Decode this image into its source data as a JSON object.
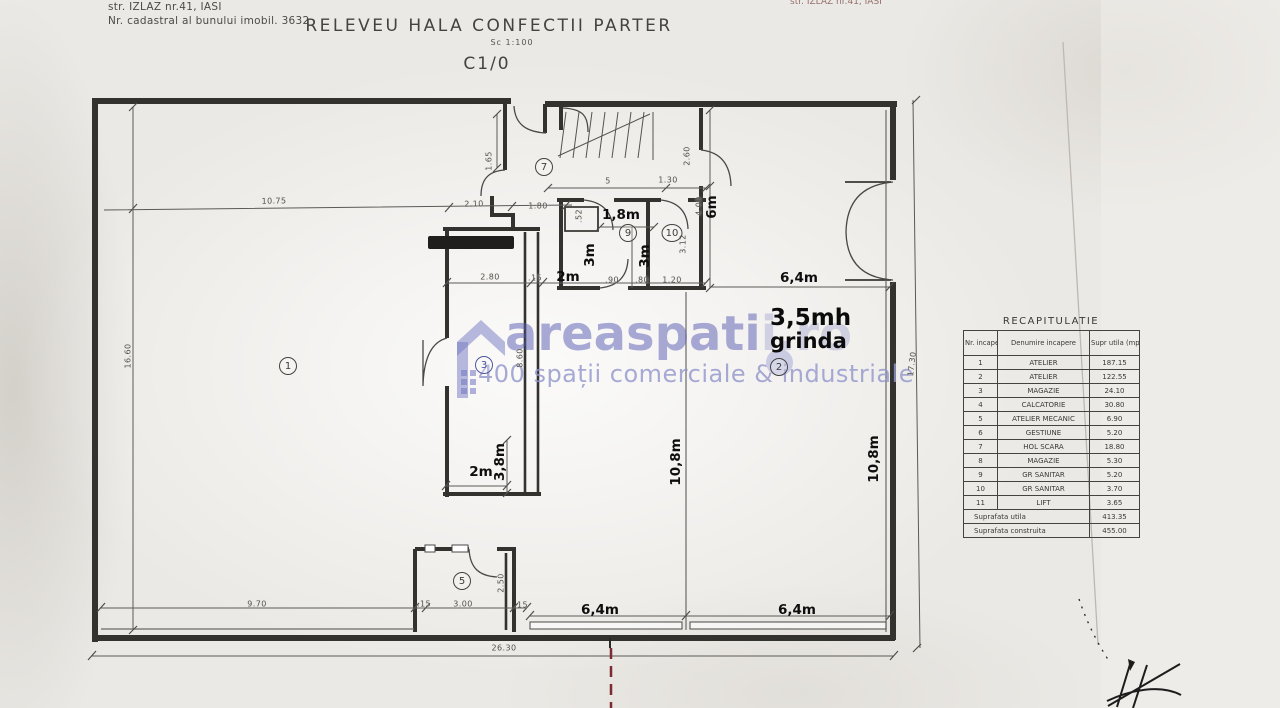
{
  "page": {
    "address_line1": "str. IZLAZ nr.41, IASI",
    "address_line2": "Nr. cadastral al bunului imobil. 3632",
    "title": "RELEVEU HALA CONFECTII PARTER",
    "scale_note": "Sc 1:100",
    "drawing_code": "C1/0",
    "top_right_fragment": "str. IZLAZ nr.41, IASI"
  },
  "watermark": {
    "brand_main": "areaspati",
    "brand_faint": "i.ro",
    "tagline": "400 spații comerciale & industriale",
    "accent_color": "#575cb2"
  },
  "recap": {
    "title": "RECAPITULATIE",
    "col_nr": "Nr. incapere",
    "col_name": "Denumire incapere",
    "col_area": "Supr utila (mp)",
    "rows": [
      [
        "1",
        "ATELIER",
        "187.15"
      ],
      [
        "2",
        "ATELIER",
        "122.55"
      ],
      [
        "3",
        "MAGAZIE",
        "24.10"
      ],
      [
        "4",
        "CALCATORIE",
        "30.80"
      ],
      [
        "5",
        "ATELIER MECANIC",
        "6.90"
      ],
      [
        "6",
        "GESTIUNE",
        "5.20"
      ],
      [
        "7",
        "HOL SCARA",
        "18.80"
      ],
      [
        "8",
        "MAGAZIE",
        "5.30"
      ],
      [
        "9",
        "GR SANITAR",
        "5.20"
      ],
      [
        "10",
        "GR SANITAR",
        "3.70"
      ],
      [
        "11",
        "LIFT",
        "3.65"
      ]
    ],
    "total_rows": [
      {
        "label": "Suprafata utila",
        "value": "413.35"
      },
      {
        "label": "Suprafata construita",
        "value": "455.00"
      }
    ]
  },
  "plan": {
    "beam_note_line1": "3,5mh",
    "beam_note_line2": "grinda",
    "rooms": [
      {
        "n": "1",
        "x": 288,
        "y": 366
      },
      {
        "n": "2",
        "x": 779,
        "y": 367
      },
      {
        "n": "3",
        "x": 484,
        "y": 365
      },
      {
        "n": "5",
        "x": 462,
        "y": 581
      },
      {
        "n": "7",
        "x": 544,
        "y": 167
      },
      {
        "n": "9",
        "x": 628,
        "y": 233
      },
      {
        "n": "10",
        "x": 672,
        "y": 233
      }
    ],
    "bold_labels": [
      {
        "t": "2m",
        "x": 568,
        "y": 277,
        "r": 0
      },
      {
        "t": "1,8m",
        "x": 621,
        "y": 215,
        "r": 0
      },
      {
        "t": "3m",
        "x": 590,
        "y": 255,
        "r": -90
      },
      {
        "t": "3m",
        "x": 645,
        "y": 256,
        "r": -90
      },
      {
        "t": "6m",
        "x": 712,
        "y": 207,
        "r": -90
      },
      {
        "t": "6,4m",
        "x": 799,
        "y": 278,
        "r": 0
      },
      {
        "t": "10,8m",
        "x": 676,
        "y": 462,
        "r": -90
      },
      {
        "t": "10,8m",
        "x": 874,
        "y": 459,
        "r": -90
      },
      {
        "t": "2m",
        "x": 481,
        "y": 472,
        "r": 0
      },
      {
        "t": "3,8m",
        "x": 500,
        "y": 462,
        "r": -90
      },
      {
        "t": "6,4m",
        "x": 600,
        "y": 610,
        "r": 0
      },
      {
        "t": "6,4m",
        "x": 797,
        "y": 610,
        "r": 0
      }
    ],
    "dims": [
      {
        "t": "10.75",
        "x": 274,
        "y": 201,
        "r": -1
      },
      {
        "t": "2.10",
        "x": 474,
        "y": 204,
        "r": -1
      },
      {
        "t": "1.80",
        "x": 538,
        "y": 206,
        "r": 0
      },
      {
        "t": "1.65",
        "x": 489,
        "y": 161,
        "r": -90
      },
      {
        "t": ".52",
        "x": 579,
        "y": 216,
        "r": -90
      },
      {
        "t": "16.60",
        "x": 128,
        "y": 356,
        "r": -90
      },
      {
        "t": "5",
        "x": 608,
        "y": 181,
        "r": 0
      },
      {
        "t": "1.30",
        "x": 668,
        "y": 180,
        "r": 0
      },
      {
        "t": "2.60",
        "x": 687,
        "y": 156,
        "r": -90
      },
      {
        "t": "4.00",
        "x": 699,
        "y": 206,
        "r": -90
      },
      {
        "t": "3.12",
        "x": 683,
        "y": 244,
        "r": -90
      },
      {
        "t": "2.80",
        "x": 490,
        "y": 277,
        "r": 0
      },
      {
        "t": ".15",
        "x": 535,
        "y": 278,
        "r": 0
      },
      {
        "t": ".90",
        "x": 612,
        "y": 280,
        "r": 0
      },
      {
        "t": ".80",
        "x": 642,
        "y": 280,
        "r": 0
      },
      {
        "t": "1.20",
        "x": 672,
        "y": 280,
        "r": 0
      },
      {
        "t": "8.60",
        "x": 520,
        "y": 358,
        "r": -90
      },
      {
        "t": "2.50",
        "x": 501,
        "y": 583,
        "r": -90
      },
      {
        "t": "9.70",
        "x": 257,
        "y": 604,
        "r": 0
      },
      {
        "t": ".15",
        "x": 424,
        "y": 604,
        "r": 0
      },
      {
        "t": "3.00",
        "x": 463,
        "y": 604,
        "r": 0
      },
      {
        "t": ".15",
        "x": 521,
        "y": 605,
        "r": 0
      },
      {
        "t": "26.30",
        "x": 504,
        "y": 648,
        "r": 0
      },
      {
        "t": "17.30",
        "x": 912,
        "y": 364,
        "r": -83
      }
    ]
  }
}
